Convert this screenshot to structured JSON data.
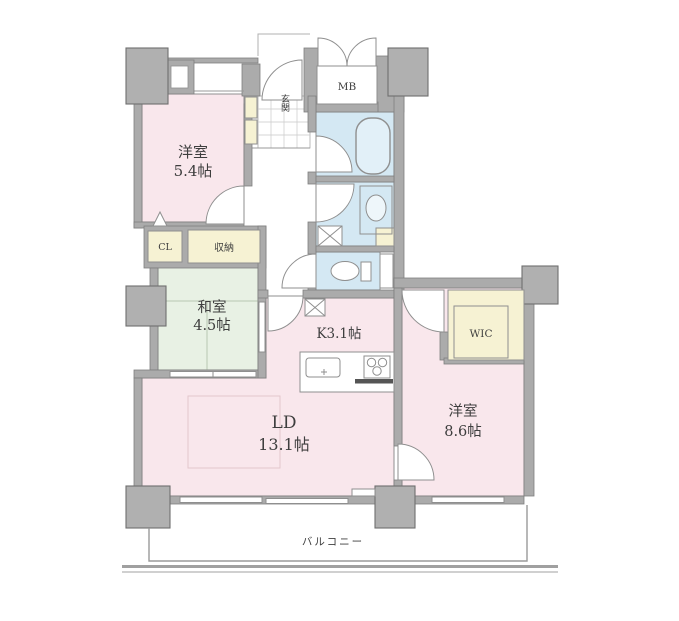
{
  "colors": {
    "wall": "#ababab",
    "wall_outline": "#7f7f7f",
    "room_pink": "#f9e7ec",
    "tatami_green": "#e8f1e4",
    "wet_blue": "#d4e8f3",
    "storage_cream": "#f6f2d3",
    "tile_white": "#ffffff",
    "text": "#3e3e3e"
  },
  "rooms": {
    "western1": {
      "name": "洋室",
      "size": "5.4帖"
    },
    "western2": {
      "name": "洋室",
      "size": "8.6帖"
    },
    "japanese": {
      "name": "和室",
      "size": "4.5帖"
    },
    "ld": {
      "name": "LD",
      "size": "13.1帖"
    },
    "kitchen": {
      "label": "K3.1帖"
    },
    "entrance": {
      "label": "玄関"
    },
    "balcony": {
      "label": "バルコニー"
    }
  },
  "storage": {
    "cl": "CL",
    "oshiire": "収納",
    "wic": "WIC",
    "mb": "MB"
  }
}
